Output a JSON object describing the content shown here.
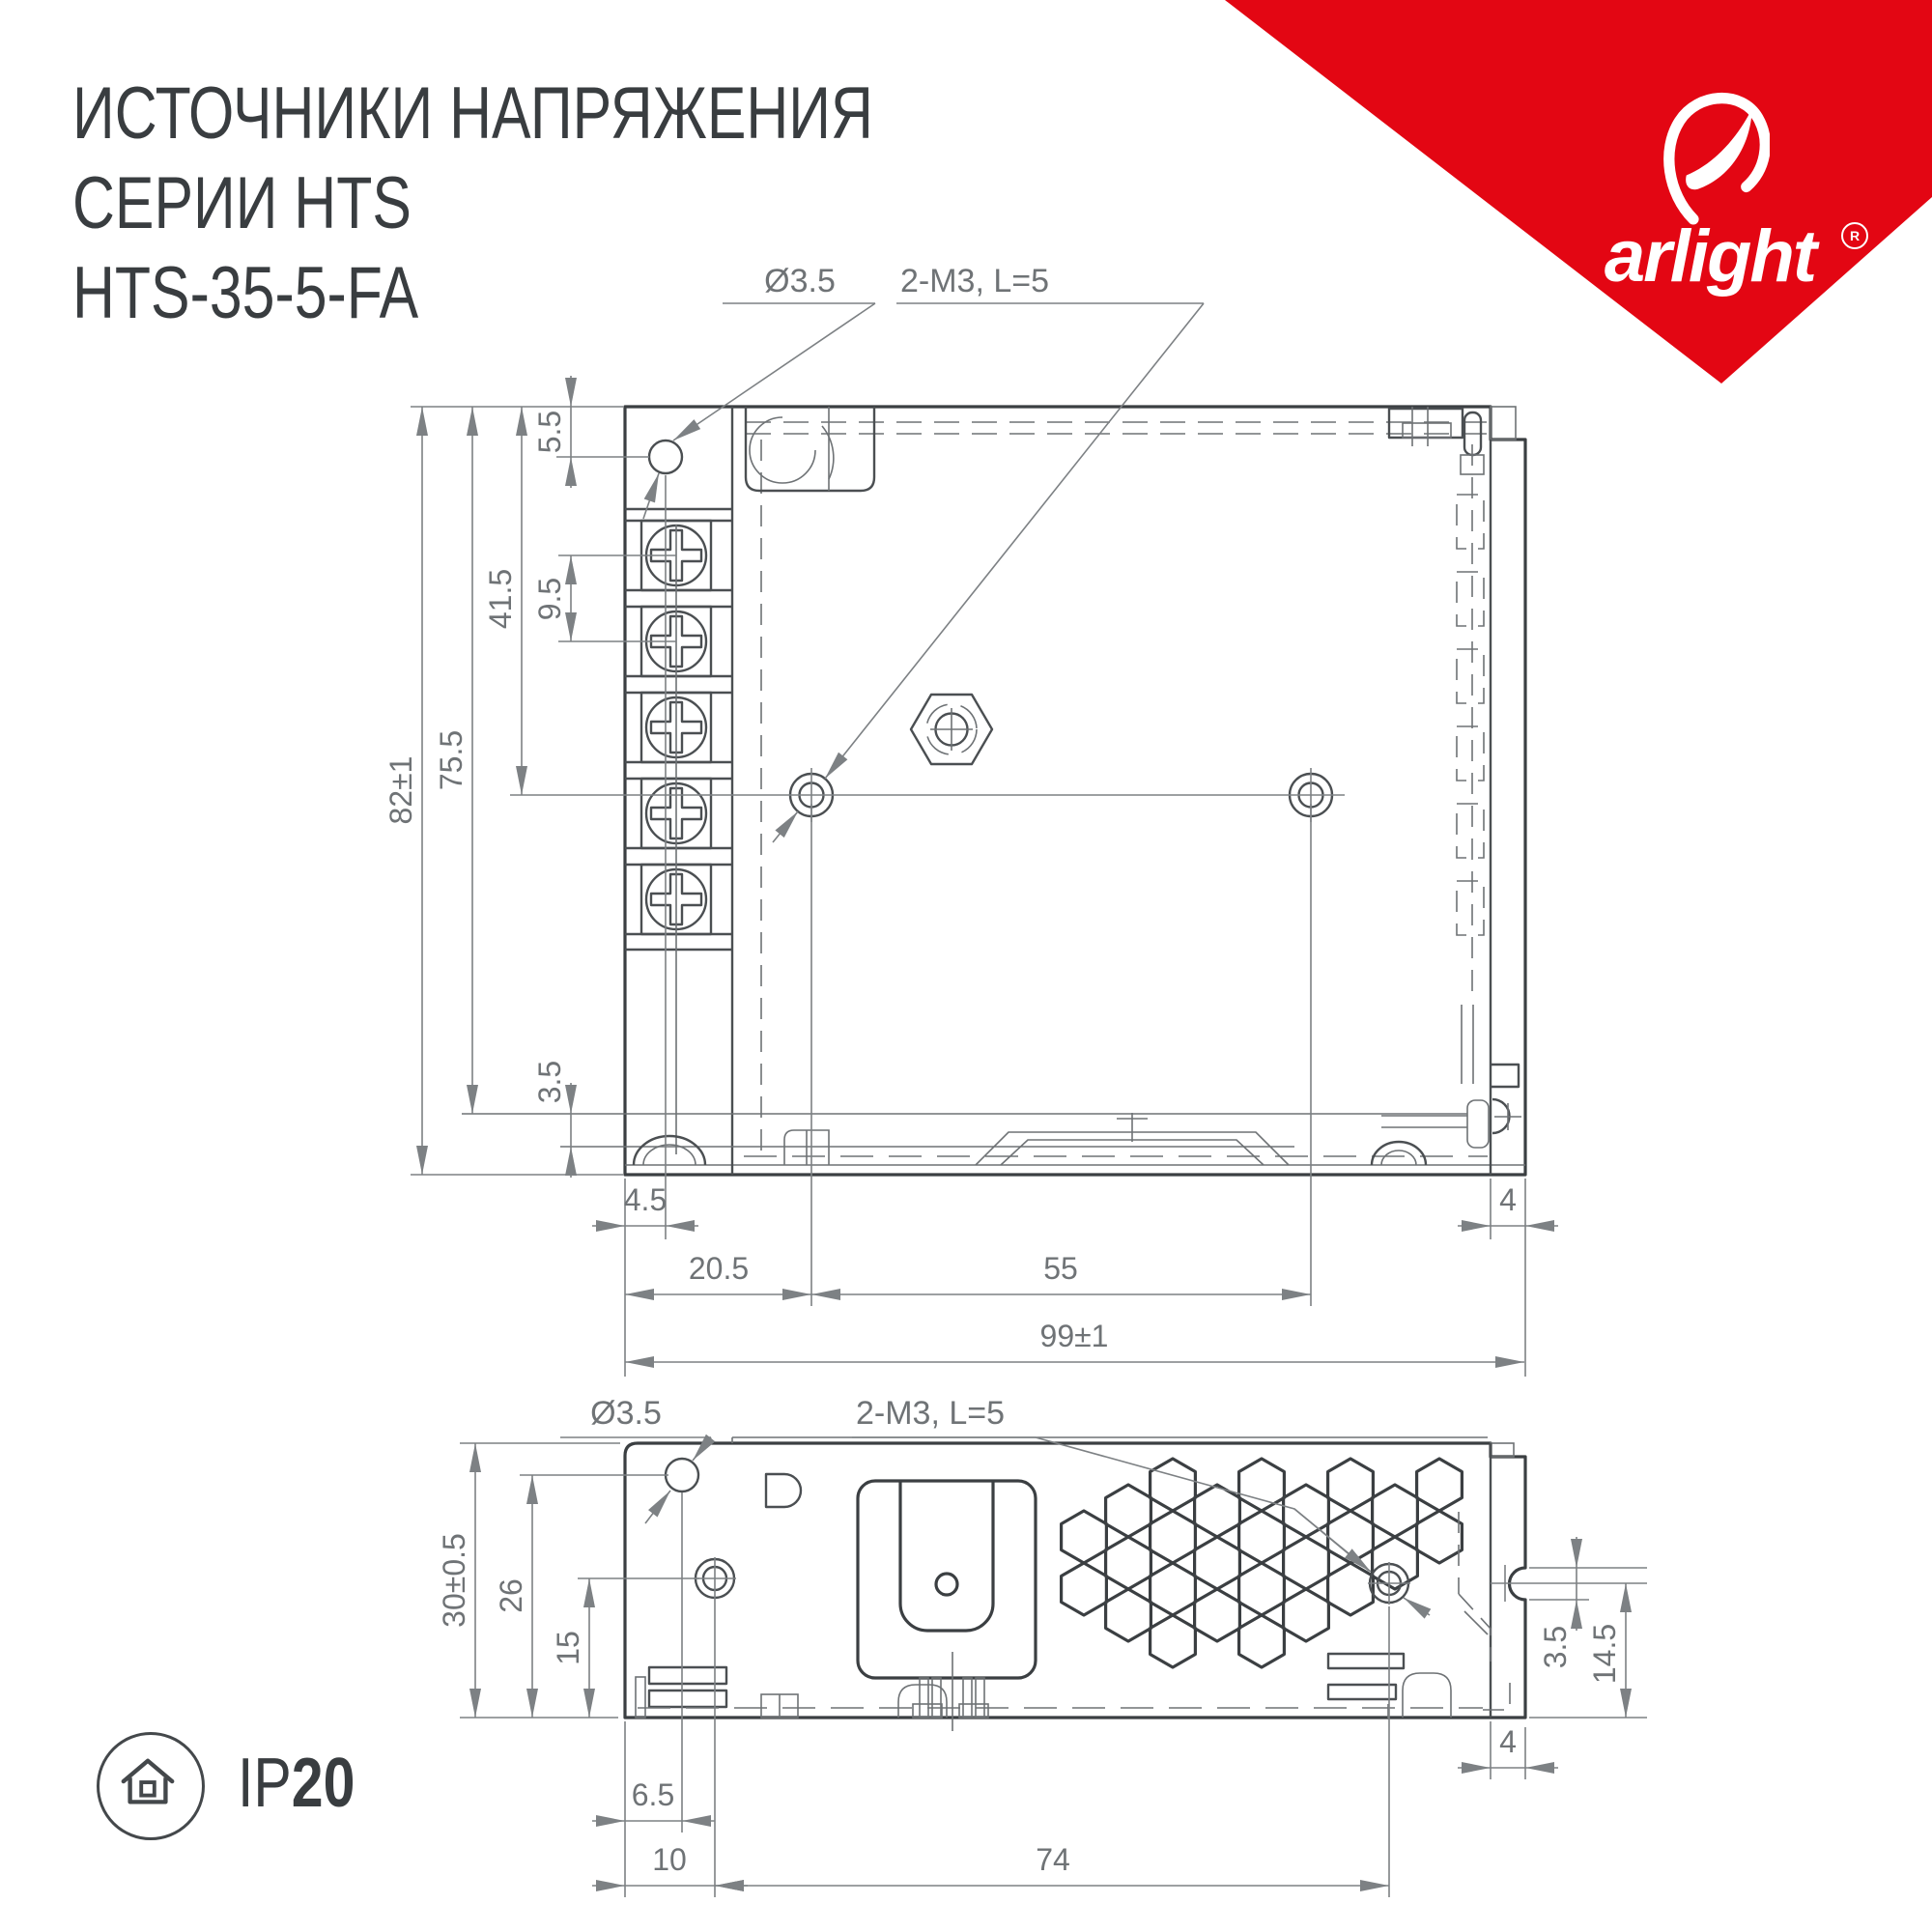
{
  "title": {
    "line1": "ИСТОЧНИКИ НАПРЯЖЕНИЯ",
    "line2": "СЕРИИ HTS",
    "line3": "HTS-35-5-FA"
  },
  "brand": {
    "name": "arlight",
    "registered": "R",
    "triangle_color": "#e30613"
  },
  "protection": {
    "prefix": "IP",
    "rating": "20"
  },
  "top_view": {
    "callout_hole": "Ø3.5",
    "callout_screws": "2-M3, L=5",
    "dim_edge_to_hole_v": "5.5",
    "dim_screw_pitch": "9.5",
    "dim_top_to_mount": "41.5",
    "dim_top_to_base": "75.5",
    "dim_height": "82±1",
    "dim_base_lip": "3.5",
    "dim_edge_to_hole_h": "4.5",
    "dim_flange": "4",
    "dim_edge_to_mount": "20.5",
    "dim_mount_spacing": "55",
    "dim_width": "99±1"
  },
  "side_view": {
    "callout_hole": "Ø3.5",
    "callout_screws": "2-M3, L=5",
    "dim_height": "30±0.5",
    "dim_hole_height": "26",
    "dim_stud_height": "15",
    "dim_notch": "3.5",
    "dim_notch_height": "14.5",
    "dim_flange": "4",
    "dim_edge_to_hole": "6.5",
    "dim_edge_to_stud": "10",
    "dim_stud_spacing": "74"
  }
}
